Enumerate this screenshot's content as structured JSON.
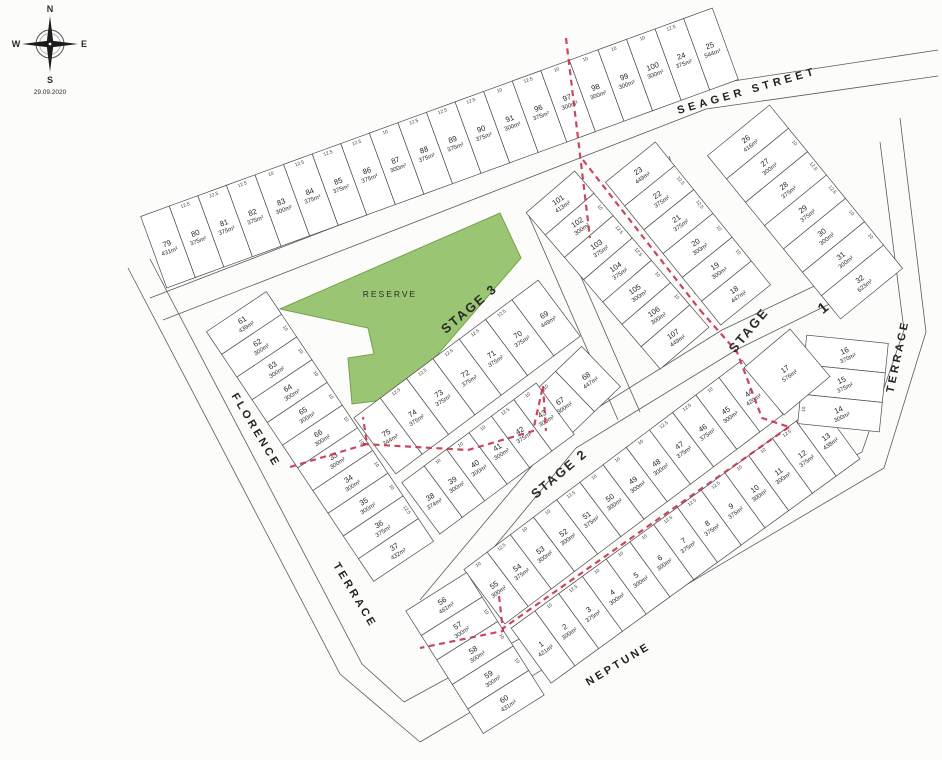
{
  "meta": {
    "date": "29.09.2020",
    "compass": [
      "N",
      "E",
      "S",
      "W"
    ]
  },
  "colors": {
    "paper": "#fcfcfa",
    "parcel_line": "#4c4c4c",
    "road_line": "#5a5a5a",
    "reserve_green": "#9ac572",
    "reserve_edge": "#74a24a",
    "stage_red": "#c5334f"
  },
  "reserve": {
    "label": "RESERVE"
  },
  "frontage_dims": {
    "300m²": "10",
    "375m²": "12.5"
  },
  "streets": [
    {
      "id": "seager-street",
      "text": "SEAGER   STREET",
      "x": 748,
      "y": 94,
      "rot": -16,
      "size": 11,
      "ls": 4
    },
    {
      "id": "florence",
      "text": "FLORENCE",
      "x": 253,
      "y": 432,
      "rot": 59,
      "size": 11,
      "ls": 3
    },
    {
      "id": "florence-terrace",
      "text": "TERRACE",
      "x": 352,
      "y": 597,
      "rot": 59,
      "size": 11,
      "ls": 3
    },
    {
      "id": "neptune",
      "text": "NEPTUNE",
      "x": 620,
      "y": 667,
      "rot": -31,
      "size": 11,
      "ls": 3
    },
    {
      "id": "neptune-terrace",
      "text": "TERRACE",
      "x": 901,
      "y": 357,
      "rot": -78,
      "size": 11,
      "ls": 3
    }
  ],
  "stages": [
    {
      "id": "stage-3",
      "text": "STAGE 3",
      "x": 472,
      "y": 312,
      "rot": -40,
      "size": 13
    },
    {
      "id": "stage-2",
      "text": "STAGE 2",
      "x": 562,
      "y": 477,
      "rot": -40,
      "size": 13
    },
    {
      "id": "stage-1-word",
      "text": "STAGE",
      "x": 752,
      "y": 333,
      "rot": -50,
      "size": 13
    },
    {
      "id": "stage-1-num",
      "text": "1",
      "x": 827,
      "y": 311,
      "rot": -40,
      "size": 15
    }
  ],
  "reserve_polygon": [
    280,
    309,
    500,
    213,
    521,
    258,
    400,
    398,
    352,
    404,
    348,
    358,
    374,
    354,
    368,
    328
  ],
  "roads": [
    [
      150,
      298,
      700,
      86
    ],
    [
      163,
      320,
      706,
      109
    ],
    [
      700,
      86,
      938,
      50
    ],
    [
      706,
      109,
      938,
      76
    ],
    [
      128,
      268,
      340,
      674,
      420,
      742
    ],
    [
      150,
      259,
      362,
      664,
      404,
      702
    ],
    [
      648,
      162,
      680,
      252,
      695,
      294
    ],
    [
      669,
      156,
      700,
      246,
      716,
      288
    ],
    [
      862,
      288,
      736,
      350,
      576,
      448,
      434,
      620
    ],
    [
      848,
      270,
      722,
      330,
      562,
      430,
      420,
      600
    ],
    [
      404,
      702,
      862,
      452,
      904,
      330,
      880,
      142
    ],
    [
      420,
      742,
      884,
      468,
      926,
      332,
      900,
      118
    ],
    [
      528,
      214,
      618,
      420
    ],
    [
      550,
      206,
      640,
      412
    ]
  ],
  "dash_lines": [
    [
      566,
      38,
      590,
      238
    ],
    [
      583,
      160,
      700,
      310
    ],
    [
      700,
      310,
      737,
      352,
      762,
      418,
      789,
      427
    ],
    [
      789,
      427,
      502,
      629
    ],
    [
      499,
      596,
      503,
      631,
      420,
      648
    ],
    [
      290,
      467,
      367,
      444,
      363,
      417
    ],
    [
      363,
      444,
      468,
      450,
      533,
      431,
      543,
      386
    ],
    [
      543,
      386,
      546,
      431
    ]
  ],
  "strips": [
    {
      "id": "north-strip",
      "x1": 168,
      "y1": 247,
      "x2": 711,
      "y2": 49,
      "depth": 76,
      "labelRot": -20,
      "lots": [
        {
          "n": "79",
          "a": "431m²"
        },
        {
          "n": "80",
          "a": "375m²"
        },
        {
          "n": "81",
          "a": "375m²"
        },
        {
          "n": "82",
          "a": "375m²"
        },
        {
          "n": "83",
          "a": "300m²"
        },
        {
          "n": "84",
          "a": "375m²"
        },
        {
          "n": "85",
          "a": "375m²"
        },
        {
          "n": "86",
          "a": "375m²"
        },
        {
          "n": "87",
          "a": "300m²"
        },
        {
          "n": "88",
          "a": "375m²"
        },
        {
          "n": "89",
          "a": "375m²"
        },
        {
          "n": "90",
          "a": "375m²"
        },
        {
          "n": "91",
          "a": "300m²"
        },
        {
          "n": "96",
          "a": "375m²"
        },
        {
          "n": "97",
          "a": "300m²"
        },
        {
          "n": "98",
          "a": "300m²"
        },
        {
          "n": "99",
          "a": "300m²"
        },
        {
          "n": "100",
          "a": "300m²"
        },
        {
          "n": "24",
          "a": "375m²"
        },
        {
          "n": "25",
          "a": "544m²"
        }
      ]
    },
    {
      "id": "east-upper",
      "x1": 748,
      "y1": 142,
      "x2": 862,
      "y2": 282,
      "depth": 80,
      "labelRot": -38,
      "lots": [
        {
          "n": "26",
          "a": "416m²"
        },
        {
          "n": "27",
          "a": "300m²"
        },
        {
          "n": "28",
          "a": "375m²"
        },
        {
          "n": "29",
          "a": "375m²"
        },
        {
          "n": "30",
          "a": "300m²"
        },
        {
          "n": "31",
          "a": "300m²"
        },
        {
          "n": "32",
          "a": "623m²"
        }
      ]
    },
    {
      "id": "center-north-west",
      "x1": 560,
      "y1": 203,
      "x2": 675,
      "y2": 337,
      "depth": 64,
      "labelRot": -34,
      "lots": [
        {
          "n": "101",
          "a": "413m²"
        },
        {
          "n": "102",
          "a": "300m²"
        },
        {
          "n": "103",
          "a": "375m²"
        },
        {
          "n": "104",
          "a": "375m²"
        },
        {
          "n": "105",
          "a": "300m²"
        },
        {
          "n": "106",
          "a": "300m²"
        },
        {
          "n": "107",
          "a": "449m²"
        }
      ]
    },
    {
      "id": "center-north-east",
      "x1": 640,
      "y1": 174,
      "x2": 736,
      "y2": 293,
      "depth": 64,
      "labelRot": -34,
      "lots": [
        {
          "n": "23",
          "a": "449m²"
        },
        {
          "n": "22",
          "a": "375m²"
        },
        {
          "n": "21",
          "a": "375m²"
        },
        {
          "n": "20",
          "a": "300m²"
        },
        {
          "n": "19",
          "a": "300m²"
        },
        {
          "n": "18",
          "a": "447m²"
        }
      ]
    },
    {
      "id": "center-mid",
      "x1": 546,
      "y1": 318,
      "x2": 388,
      "y2": 436,
      "depth": 70,
      "labelRot": -32,
      "lots": [
        {
          "n": "69",
          "a": "449m²"
        },
        {
          "n": "70",
          "a": "375m²"
        },
        {
          "n": "71",
          "a": "375m²"
        },
        {
          "n": "72",
          "a": "375m²"
        },
        {
          "n": "73",
          "a": "375m²"
        },
        {
          "n": "74",
          "a": "375m²"
        },
        {
          "n": "75",
          "a": "344m²"
        }
      ]
    },
    {
      "id": "center-mid-east",
      "x1": 588,
      "y1": 379,
      "x2": 562,
      "y2": 404,
      "depth": 56,
      "labelRot": -34,
      "lots": [
        {
          "n": "68",
          "a": "447m²"
        },
        {
          "n": "67",
          "a": "300m²"
        }
      ]
    },
    {
      "id": "center-low",
      "x1": 544,
      "y1": 417,
      "x2": 432,
      "y2": 500,
      "depth": 64,
      "labelRot": -32,
      "lots": [
        {
          "n": "43",
          "a": "300m²"
        },
        {
          "n": "42",
          "a": "375m²"
        },
        {
          "n": "41",
          "a": "300m²"
        },
        {
          "n": "40",
          "a": "300m²"
        },
        {
          "n": "39",
          "a": "300m²"
        },
        {
          "n": "38",
          "a": "374m²"
        }
      ]
    },
    {
      "id": "west-strip",
      "x1": 244,
      "y1": 323,
      "x2": 396,
      "y2": 550,
      "depth": 72,
      "labelRot": -32,
      "lots": [
        {
          "n": "61",
          "a": "439m²"
        },
        {
          "n": "62",
          "a": "300m²"
        },
        {
          "n": "63",
          "a": "300m²"
        },
        {
          "n": "64",
          "a": "300m²"
        },
        {
          "n": "65",
          "a": "300m²"
        },
        {
          "n": "66",
          "a": "300m²"
        },
        {
          "n": "33",
          "a": "300m²"
        },
        {
          "n": "34",
          "a": "300m²"
        },
        {
          "n": "35",
          "a": "300m²"
        },
        {
          "n": "36",
          "a": "375m²"
        },
        {
          "n": "37",
          "a": "432m²"
        }
      ]
    },
    {
      "id": "stage2-strip",
      "x1": 751,
      "y1": 396,
      "x2": 496,
      "y2": 588,
      "depth": 68,
      "labelRot": -35,
      "lots": [
        {
          "n": "44",
          "a": "420m²"
        },
        {
          "n": "45",
          "a": "300m²"
        },
        {
          "n": "46",
          "a": "375m²"
        },
        {
          "n": "47",
          "a": "375m²"
        },
        {
          "n": "48",
          "a": "300m²"
        },
        {
          "n": "49",
          "a": "300m²"
        },
        {
          "n": "50",
          "a": "300m²"
        },
        {
          "n": "51",
          "a": "375m²"
        },
        {
          "n": "52",
          "a": "300m²"
        },
        {
          "n": "53",
          "a": "300m²"
        },
        {
          "n": "54",
          "a": "375m²"
        },
        {
          "n": "55",
          "a": "300m²"
        }
      ]
    },
    {
      "id": "neptune-strip",
      "x1": 828,
      "y1": 440,
      "x2": 543,
      "y2": 647,
      "depth": 68,
      "labelRot": -35,
      "lots": [
        {
          "n": "13",
          "a": "438m²"
        },
        {
          "n": "12",
          "a": "375m²"
        },
        {
          "n": "11",
          "a": "300m²"
        },
        {
          "n": "10",
          "a": "300m²"
        },
        {
          "n": "9",
          "a": "375m²"
        },
        {
          "n": "8",
          "a": "375m²"
        },
        {
          "n": "7",
          "a": "375m²"
        },
        {
          "n": "6",
          "a": "300m²"
        },
        {
          "n": "5",
          "a": "300m²"
        },
        {
          "n": "4",
          "a": "300m²"
        },
        {
          "n": "3",
          "a": "375m²"
        },
        {
          "n": "2",
          "a": "300m²"
        },
        {
          "n": "1",
          "a": "421m²"
        }
      ]
    },
    {
      "id": "east-mid",
      "x1": 846,
      "y1": 354,
      "x2": 840,
      "y2": 413,
      "depth": 82,
      "labelRot": -25,
      "lots": [
        {
          "n": "16",
          "a": "370m²"
        },
        {
          "n": "15",
          "a": "375m²"
        },
        {
          "n": "14",
          "a": "300m²"
        }
      ]
    },
    {
      "id": "south-west",
      "x1": 444,
      "y1": 604,
      "x2": 506,
      "y2": 702,
      "depth": 72,
      "labelRot": -33,
      "lots": [
        {
          "n": "56",
          "a": "461m²"
        },
        {
          "n": "57",
          "a": "300m²"
        },
        {
          "n": "58",
          "a": "300m²"
        },
        {
          "n": "59",
          "a": "300m²"
        },
        {
          "n": "60",
          "a": "431m²"
        }
      ]
    },
    {
      "id": "lot-17-block",
      "x1": 787,
      "y1": 372,
      "x2": 787,
      "y2": 372,
      "depth": 60,
      "w": 62,
      "dir": 50,
      "labelRot": -35,
      "lots": [
        {
          "n": "17",
          "a": "576m²"
        }
      ]
    }
  ]
}
